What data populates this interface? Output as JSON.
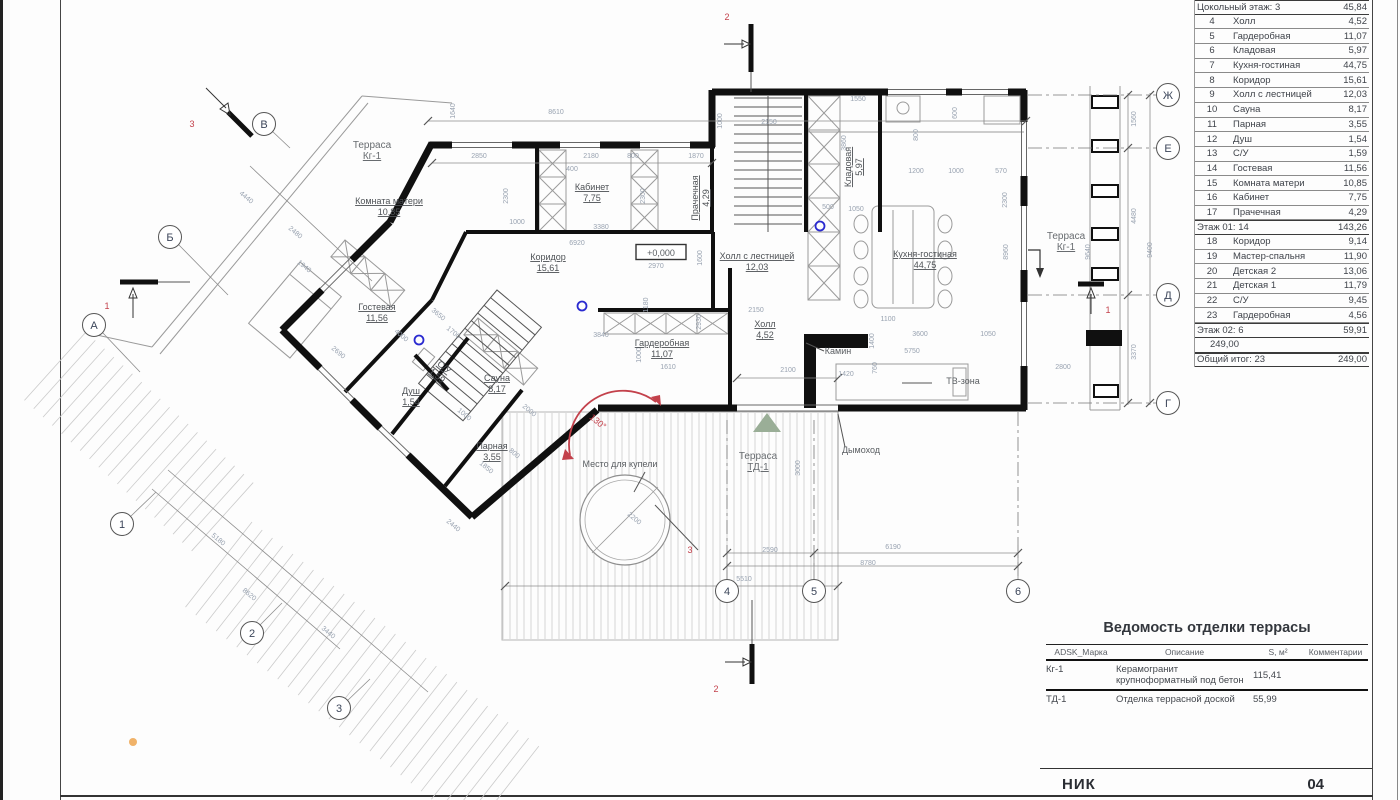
{
  "title_block": {
    "project": "НИК",
    "sheet_number": "04"
  },
  "room_schedule": {
    "rows": [
      {
        "n": "3",
        "name": "Котельная",
        "a": "3,81",
        "cut": true
      },
      {
        "g": "Цокольный этаж: 3",
        "a": "45,84"
      },
      {
        "n": "4",
        "name": "Холл",
        "a": "4,52"
      },
      {
        "n": "5",
        "name": "Гардеробная",
        "a": "11,07"
      },
      {
        "n": "6",
        "name": "Кладовая",
        "a": "5,97"
      },
      {
        "n": "7",
        "name": "Кухня-гостиная",
        "a": "44,75"
      },
      {
        "n": "8",
        "name": "Коридор",
        "a": "15,61"
      },
      {
        "n": "9",
        "name": "Холл с лестницей",
        "a": "12,03"
      },
      {
        "n": "10",
        "name": "Сауна",
        "a": "8,17"
      },
      {
        "n": "11",
        "name": "Парная",
        "a": "3,55"
      },
      {
        "n": "12",
        "name": "Душ",
        "a": "1,54"
      },
      {
        "n": "13",
        "name": "С/У",
        "a": "1,59"
      },
      {
        "n": "14",
        "name": "Гостевая",
        "a": "11,56"
      },
      {
        "n": "15",
        "name": "Комната матери",
        "a": "10,85"
      },
      {
        "n": "16",
        "name": "Кабинет",
        "a": "7,75"
      },
      {
        "n": "17",
        "name": "Прачечная",
        "a": "4,29"
      },
      {
        "g": "Этаж 01: 14",
        "a": "143,26"
      },
      {
        "n": "18",
        "name": "Коридор",
        "a": "9,14"
      },
      {
        "n": "19",
        "name": "Мастер-спальня",
        "a": "11,90"
      },
      {
        "n": "20",
        "name": "Детская 2",
        "a": "13,06"
      },
      {
        "n": "21",
        "name": "Детская 1",
        "a": "11,79"
      },
      {
        "n": "22",
        "name": "С/У",
        "a": "9,45"
      },
      {
        "n": "23",
        "name": "Гардеробная",
        "a": "4,56"
      },
      {
        "g": "Этаж 02: 6",
        "a": "59,91"
      },
      {
        "g": "",
        "a": "249,00",
        "blank": true
      },
      {
        "g": "Общий итог: 23",
        "a": "249,00"
      }
    ]
  },
  "terrace_table": {
    "title": "Ведомость отделки террасы",
    "headers": [
      "ADSK_Марка",
      "Описание",
      "S, м²",
      "Комментарии"
    ],
    "rows": [
      {
        "mark": "Кг-1",
        "desc": "Керамогранит крупноформатный под бетон",
        "s": "115,41",
        "comment": ""
      },
      {
        "mark": "ТД-1",
        "desc": "Отделка террасной доской",
        "s": "55,99",
        "comment": ""
      }
    ]
  },
  "plan": {
    "rooms": [
      {
        "name": "Терраса",
        "area": "Кг-1",
        "x": 372,
        "y": 150,
        "terrace": true
      },
      {
        "name": "Комната матери",
        "area": "10,85",
        "x": 389,
        "y": 206
      },
      {
        "name": "Кабинет",
        "area": "7,75",
        "x": 592,
        "y": 192
      },
      {
        "name": "Прачечная",
        "area": "4,29",
        "x": 700,
        "y": 198,
        "r": -90
      },
      {
        "name": "Кладовая",
        "area": "5,97",
        "x": 853,
        "y": 167,
        "r": -90
      },
      {
        "name": "Коридор",
        "area": "15,61",
        "x": 548,
        "y": 262
      },
      {
        "name": "Холл с лестницей",
        "area": "12,03",
        "x": 757,
        "y": 261
      },
      {
        "name": "Кухня-гостиная",
        "area": "44,75",
        "x": 925,
        "y": 259
      },
      {
        "name": "Терраса",
        "area": "Кг-1",
        "x": 1066,
        "y": 241,
        "terrace": true
      },
      {
        "name": "Гостевая",
        "area": "11,56",
        "x": 377,
        "y": 312
      },
      {
        "name": "С/У",
        "area": "1,59",
        "x": 441,
        "y": 371,
        "r": 40
      },
      {
        "name": "Душ",
        "area": "1,54",
        "x": 411,
        "y": 396
      },
      {
        "name": "Сауна",
        "area": "8,17",
        "x": 497,
        "y": 383
      },
      {
        "name": "Парная",
        "area": "3,55",
        "x": 492,
        "y": 451
      },
      {
        "name": "Гардеробная",
        "area": "11,07",
        "x": 662,
        "y": 348
      },
      {
        "name": "Холл",
        "area": "4,52",
        "x": 765,
        "y": 329
      },
      {
        "name": "Терраса",
        "area": "ТД-1",
        "x": 758,
        "y": 461,
        "terrace": true
      }
    ],
    "labels": [
      {
        "t": "Камин",
        "x": 838,
        "y": 354
      },
      {
        "t": "Дымоход",
        "x": 861,
        "y": 453
      },
      {
        "t": "ТВ-зона",
        "x": 963,
        "y": 384
      },
      {
        "t": "Место для купели",
        "x": 620,
        "y": 467
      },
      {
        "t": "+0,000",
        "x": 661,
        "y": 256,
        "boxed": true
      }
    ],
    "angle_note": {
      "t": "130°",
      "x": 596,
      "y": 424,
      "r": 40
    },
    "elevation_mark": "+0,000",
    "section_labels": [
      {
        "t": "2",
        "x": 727,
        "y": 20
      },
      {
        "t": "2",
        "x": 716,
        "y": 692
      },
      {
        "t": "1",
        "x": 107,
        "y": 309
      },
      {
        "t": "3",
        "x": 192,
        "y": 127
      },
      {
        "t": "3",
        "x": 690,
        "y": 553
      },
      {
        "t": "1",
        "x": 1108,
        "y": 313
      }
    ],
    "axis_letters": [
      {
        "t": "Ж",
        "x": 1168,
        "y": 95
      },
      {
        "t": "Е",
        "x": 1168,
        "y": 148
      },
      {
        "t": "Д",
        "x": 1168,
        "y": 295
      },
      {
        "t": "Г",
        "x": 1168,
        "y": 403
      },
      {
        "t": "В",
        "x": 264,
        "y": 124
      },
      {
        "t": "Б",
        "x": 170,
        "y": 237
      },
      {
        "t": "А",
        "x": 94,
        "y": 325
      }
    ],
    "axis_numbers": [
      {
        "t": "1",
        "x": 122,
        "y": 524
      },
      {
        "t": "2",
        "x": 252,
        "y": 633
      },
      {
        "t": "3",
        "x": 339,
        "y": 708
      },
      {
        "t": "4",
        "x": 727,
        "y": 591
      },
      {
        "t": "5",
        "x": 814,
        "y": 591
      },
      {
        "t": "6",
        "x": 1018,
        "y": 591
      }
    ],
    "dims": [
      {
        "t": "8610",
        "x": 556,
        "y": 114
      },
      {
        "t": "1640",
        "x": 455,
        "y": 111,
        "r": -90
      },
      {
        "t": "2850",
        "x": 479,
        "y": 158
      },
      {
        "t": "2180",
        "x": 591,
        "y": 158
      },
      {
        "t": "800",
        "x": 633,
        "y": 158
      },
      {
        "t": "1870",
        "x": 696,
        "y": 158
      },
      {
        "t": "400",
        "x": 572,
        "y": 171
      },
      {
        "t": "1000",
        "x": 517,
        "y": 224
      },
      {
        "t": "3380",
        "x": 601,
        "y": 229
      },
      {
        "t": "2300",
        "x": 508,
        "y": 196,
        "r": -90
      },
      {
        "t": "2300",
        "x": 645,
        "y": 196,
        "r": -90
      },
      {
        "t": "2300",
        "x": 1007,
        "y": 200,
        "r": -90
      },
      {
        "t": "6920",
        "x": 577,
        "y": 245
      },
      {
        "t": "2970",
        "x": 656,
        "y": 268
      },
      {
        "t": "1600",
        "x": 702,
        "y": 258,
        "r": -90
      },
      {
        "t": "1000",
        "x": 722,
        "y": 121,
        "r": -90
      },
      {
        "t": "2150",
        "x": 769,
        "y": 124
      },
      {
        "t": "2150",
        "x": 756,
        "y": 312
      },
      {
        "t": "3840",
        "x": 601,
        "y": 337
      },
      {
        "t": "2930",
        "x": 701,
        "y": 322,
        "r": -90
      },
      {
        "t": "1610",
        "x": 668,
        "y": 369
      },
      {
        "t": "2100",
        "x": 788,
        "y": 372
      },
      {
        "t": "5510",
        "x": 744,
        "y": 581
      },
      {
        "t": "2590",
        "x": 770,
        "y": 552
      },
      {
        "t": "6190",
        "x": 893,
        "y": 549
      },
      {
        "t": "8780",
        "x": 868,
        "y": 565
      },
      {
        "t": "3000",
        "x": 800,
        "y": 468,
        "r": -90
      },
      {
        "t": "1100",
        "x": 888,
        "y": 321
      },
      {
        "t": "3600",
        "x": 920,
        "y": 336
      },
      {
        "t": "1050",
        "x": 988,
        "y": 336
      },
      {
        "t": "5750",
        "x": 912,
        "y": 353
      },
      {
        "t": "1420",
        "x": 846,
        "y": 376
      },
      {
        "t": "760",
        "x": 877,
        "y": 368,
        "r": -90
      },
      {
        "t": "1400",
        "x": 874,
        "y": 341,
        "r": -90
      },
      {
        "t": "2800",
        "x": 1063,
        "y": 369
      },
      {
        "t": "3370",
        "x": 1136,
        "y": 352,
        "r": -90
      },
      {
        "t": "4480",
        "x": 1136,
        "y": 216,
        "r": -90
      },
      {
        "t": "1560",
        "x": 1136,
        "y": 119,
        "r": -90
      },
      {
        "t": "9400",
        "x": 1152,
        "y": 250,
        "r": -90
      },
      {
        "t": "9640",
        "x": 1090,
        "y": 252,
        "r": -90
      },
      {
        "t": "8960",
        "x": 1008,
        "y": 252,
        "r": -90
      },
      {
        "t": "1550",
        "x": 858,
        "y": 101
      },
      {
        "t": "3860",
        "x": 846,
        "y": 143,
        "r": -90
      },
      {
        "t": "600",
        "x": 957,
        "y": 113,
        "r": -90
      },
      {
        "t": "800",
        "x": 918,
        "y": 135,
        "r": -90
      },
      {
        "t": "1200",
        "x": 916,
        "y": 173
      },
      {
        "t": "1000",
        "x": 956,
        "y": 173
      },
      {
        "t": "570",
        "x": 1001,
        "y": 173
      },
      {
        "t": "500",
        "x": 828,
        "y": 209
      },
      {
        "t": "1050",
        "x": 856,
        "y": 211
      },
      {
        "t": "4440",
        "x": 245,
        "y": 199,
        "r": 40
      },
      {
        "t": "2480",
        "x": 294,
        "y": 234,
        "r": 40
      },
      {
        "t": "1940",
        "x": 303,
        "y": 268,
        "r": 40
      },
      {
        "t": "2690",
        "x": 337,
        "y": 354,
        "r": 40
      },
      {
        "t": "4000",
        "x": 400,
        "y": 337,
        "r": 40
      },
      {
        "t": "1700",
        "x": 452,
        "y": 334,
        "r": 40
      },
      {
        "t": "3650",
        "x": 437,
        "y": 316,
        "r": 40
      },
      {
        "t": "2000",
        "x": 528,
        "y": 412,
        "r": 40
      },
      {
        "t": "1000",
        "x": 463,
        "y": 416,
        "r": 40
      },
      {
        "t": "1850",
        "x": 485,
        "y": 469,
        "r": 40
      },
      {
        "t": "800",
        "x": 513,
        "y": 455,
        "r": 40
      },
      {
        "t": "5180",
        "x": 217,
        "y": 541,
        "r": 40
      },
      {
        "t": "8620",
        "x": 248,
        "y": 596,
        "r": 40
      },
      {
        "t": "3440",
        "x": 327,
        "y": 634,
        "r": 40
      },
      {
        "t": "2440",
        "x": 452,
        "y": 527,
        "r": 40
      },
      {
        "t": "2200",
        "x": 633,
        "y": 520,
        "r": 40
      },
      {
        "t": "1180",
        "x": 648,
        "y": 305,
        "r": -90
      },
      {
        "t": "1000",
        "x": 641,
        "y": 355,
        "r": -90
      }
    ],
    "colors": {
      "wall": "#101010",
      "dim_text": "#98a2b0",
      "label_text": "#4e5256",
      "red": "#c3414b",
      "blue": "#2a2ad0",
      "orange": "#f0b269",
      "green": "#9aae97"
    }
  }
}
